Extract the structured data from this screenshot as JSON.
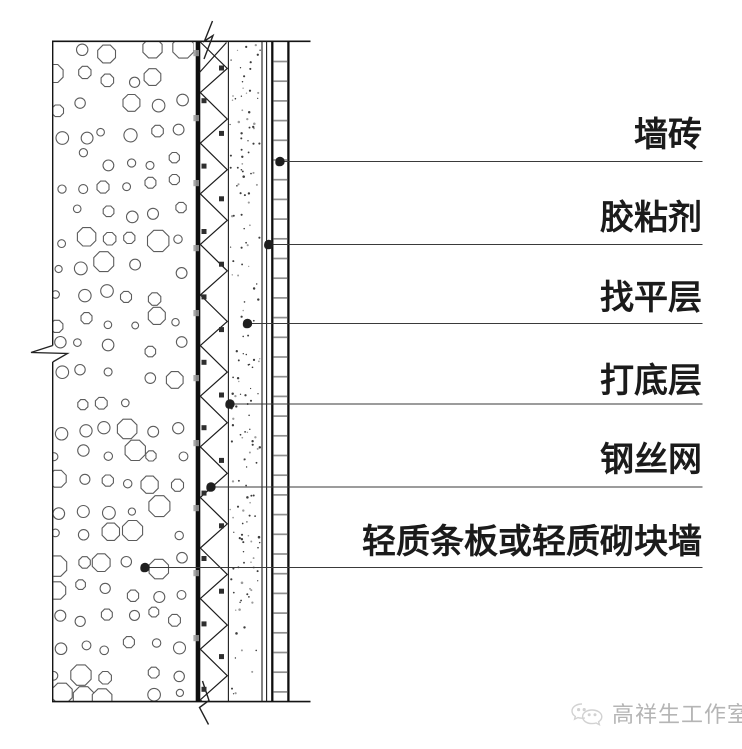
{
  "labels": [
    {
      "text": "墙砖"
    },
    {
      "text": "胶粘剂"
    },
    {
      "text": "找平层"
    },
    {
      "text": "打底层"
    },
    {
      "text": "钢丝网"
    },
    {
      "text": "轻质条板或轻质砌块墙"
    }
  ],
  "watermark": {
    "studio_name": "高祥生工作室",
    "logo": "speech-bubbles-icon"
  },
  "colors": {
    "ink": "#1c1c1c",
    "edge": "#141414",
    "thick_line": "#0e0e0e",
    "aggregate_outline": "#5c5c5c",
    "leader": "#3a3a3a",
    "dot": "#1f1f1f",
    "rung_gray": "#8f8f8f",
    "anchor_gray": "#9a9a9a",
    "stipple_dark": "#3c3c3c",
    "stipple_light": "#9a9a9a",
    "watermark_gray": "#b5b5b5",
    "watermark_icon": "#d2d2d2",
    "background": "#ffffff"
  }
}
